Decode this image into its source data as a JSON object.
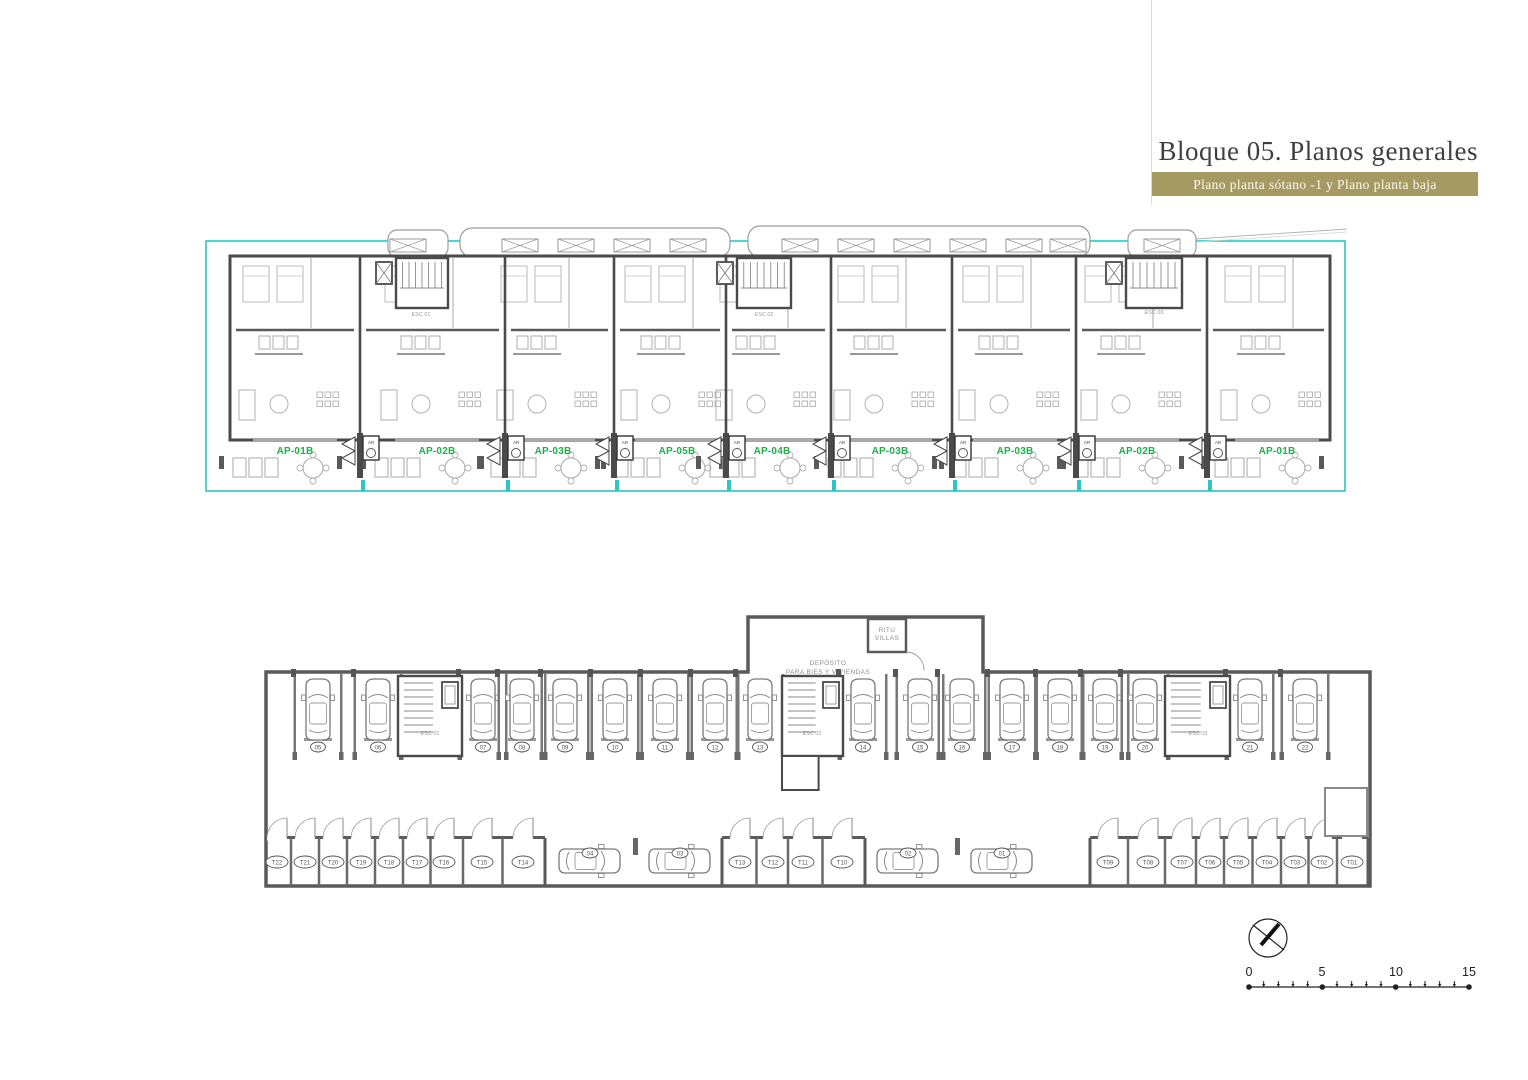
{
  "title": "Bloque 05. Planos generales",
  "subtitle": "Plano planta sótano -1 y Plano planta baja",
  "plans": {
    "upper": {
      "name": "Plano planta baja",
      "apartments": [
        "AP-01B",
        "AP-02B",
        "AP-03B",
        "AP-05B",
        "AP-04B",
        "AP-03B",
        "AP-03B",
        "AP-02B",
        "AP-01B"
      ],
      "stairs": [
        "ESC 01",
        "ESC 02",
        "ESC 03"
      ],
      "closet_label": "AR",
      "boundary_color": "#2ec4c4",
      "label_color": "#1fae4b"
    },
    "lower": {
      "name": "Plano planta sótano -1",
      "parking_row": [
        "05",
        "06",
        "07",
        "08",
        "09",
        "10",
        "11",
        "12",
        "13",
        "14",
        "15",
        "16",
        "17",
        "18",
        "19",
        "20",
        "21",
        "22"
      ],
      "parking_aisle": [
        "04",
        "03",
        "02",
        "01"
      ],
      "storage_group_a": [
        "T22",
        "T21",
        "T20",
        "T19",
        "T18",
        "T17",
        "T16",
        "T15",
        "T14"
      ],
      "storage_group_b": [
        "T13",
        "T12",
        "T11",
        "T10"
      ],
      "storage_group_c": [
        "T09",
        "T08",
        "T07",
        "T06",
        "T05",
        "T04",
        "T03",
        "T02",
        "T01"
      ],
      "stairs": [
        "ESC 01",
        "ESC 02",
        "ESC 03"
      ],
      "deposit_room_line1": "DEPÓSITO",
      "deposit_room_line2": "PARA BIES Y VIVIENDAS",
      "ritu_room_line1": "RITU",
      "ritu_room_line2": "VILLAS"
    }
  },
  "icons": {
    "north": "north-arrow-compass"
  },
  "scale_bar": {
    "labels": [
      "0",
      "5",
      "10",
      "15"
    ]
  }
}
